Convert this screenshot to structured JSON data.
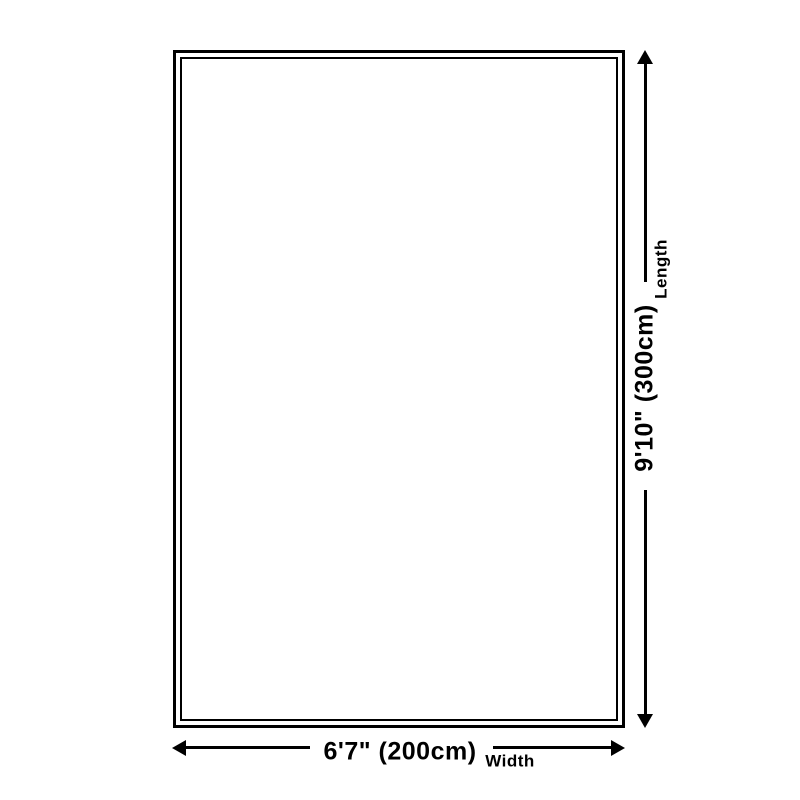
{
  "diagram": {
    "type": "product-dimension-diagram",
    "colors": {
      "line": "#000000",
      "background": "#ffffff"
    },
    "length": {
      "value": "9'10\" (300cm)",
      "label": "Length"
    },
    "width": {
      "value": "6'7\" (200cm)",
      "label": "Width"
    }
  }
}
